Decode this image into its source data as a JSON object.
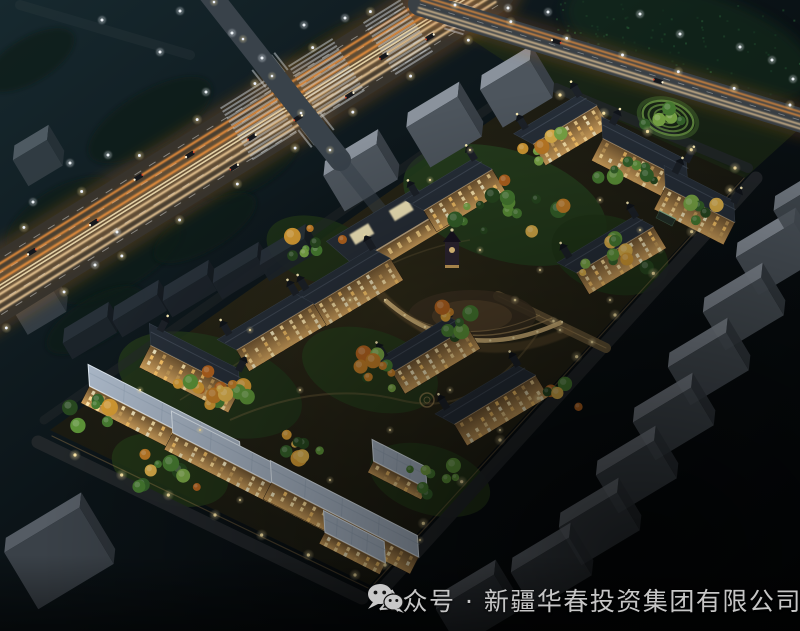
{
  "caption": {
    "icon": "wechat-icon",
    "text": "公众号 · 新疆华春投资集团有限公司"
  },
  "scene": {
    "alt": "Aerial night-view rendering of a residential compound beside a lit highway",
    "palette": {
      "sky_top": "#17292f",
      "sky_mid": "#0b1317",
      "sky_bottom": "#040608",
      "road_base": "#37332c",
      "road_glow": "#c06a28",
      "trail_hot": "#ff9a3c",
      "trail_warm": "#ffd9a2",
      "median": "#f0ddb0",
      "facade_top": "#6e5330",
      "facade_bottom": "#d4a45e",
      "window_glow": "#ffd98c",
      "eave_glow": "#ffd9a0",
      "roof_dark": "#262e38",
      "roof_light": "#a7b4c4",
      "roof_light_trim": "#dde6ee",
      "tree_green": "#477c31",
      "tree_autumn": "#cc8a30",
      "slab_top": "#8a929c",
      "slab_front": "#4d555d",
      "slab_side": "#383f46",
      "lamp_warm": "#ffe9a8",
      "lamp_cool": "#eef3ff",
      "plaza_stone": "#d9b97c",
      "caption_text": "#c6c6c6"
    }
  }
}
